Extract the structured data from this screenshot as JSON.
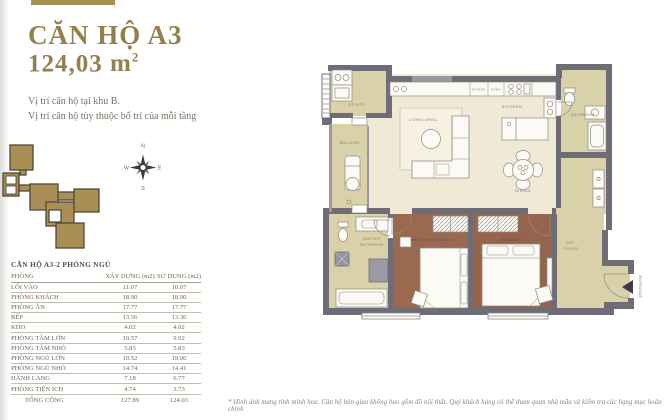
{
  "header": {
    "title": "CĂN HỘ A3",
    "area_value": "124,03",
    "area_unit": "m",
    "area_exp": "2"
  },
  "location": {
    "line1": "Vị trí căn hộ tại khu B.",
    "line2": "Vị trí căn hộ tùy thuộc bố trí của mỗi tầng"
  },
  "compass": {
    "n": "N",
    "e": "E",
    "s": "S",
    "w": "W"
  },
  "table": {
    "title": "CĂN HỘ A3-2 PHÒNG NGỦ",
    "columns": [
      "PHÒNG",
      "XÂY DỰNG (m2)",
      "SỬ DỤNG (m2)"
    ],
    "rows": [
      {
        "name": "LỐI VÀO",
        "xd": "11.07",
        "sd": "10.07"
      },
      {
        "name": "PHÒNG KHÁCH",
        "xd": "18.90",
        "sd": "18.90"
      },
      {
        "name": "PHÒNG ĂN",
        "xd": "17.77",
        "sd": "17.77"
      },
      {
        "name": "BẾP",
        "xd": "13.56",
        "sd": "13.36"
      },
      {
        "name": "KHO",
        "xd": "4.02",
        "sd": "4.02"
      },
      {
        "name": "PHÒNG TẮM LỚN",
        "xd": "10.57",
        "sd": "9.92"
      },
      {
        "name": "PHÒNG TẮM NHỎ",
        "xd": "5.83",
        "sd": "5.83"
      },
      {
        "name": "PHÒNG NGỦ LỚN",
        "xd": "19.52",
        "sd": "19.06"
      },
      {
        "name": "PHÒNG NGỦ NHỎ",
        "xd": "14.74",
        "sd": "14.41"
      },
      {
        "name": "HÀNH LANG",
        "xd": "7.18",
        "sd": "6.77"
      },
      {
        "name": "PHÒNG TIỆN ÍCH",
        "xd": "4.74",
        "sd": "3.73"
      }
    ],
    "total": {
      "name": "TỔNG CỘNG",
      "xd": "127.89",
      "sd": "124.03"
    }
  },
  "floorplan": {
    "labels": {
      "utility": "UTILITY",
      "balcony": "BALCONY",
      "living": "LIVING AREA",
      "kitchen": "KITCHEN",
      "fridge": "FRIDGE",
      "oven": "OVEN",
      "bathroom": "BATHROOM",
      "dining": "DINING",
      "master_bath_1": "MASTER",
      "master_bath_2": "BATHROOM",
      "master_bedroom": "MASTER BEDROOM",
      "bedroom": "BEDROOM",
      "foyer_1": "ENT.",
      "foyer_2": "FOYER",
      "entrance": "ENTRANCE"
    }
  },
  "footnote": "* Hình ảnh mang tính minh họa. Căn hộ bàn giao không bao gồm đồ nội thất. Quý khách hàng có thể tham quan nhà mẫu và kiểm tra các hạng mục hoàn chỉnh",
  "colors": {
    "accent": "#a8914e",
    "wall": "#6e6c77",
    "floor_cream": "#efe9d5",
    "floor_tan": "#d8d1aa",
    "floor_brown": "#9a6951"
  }
}
